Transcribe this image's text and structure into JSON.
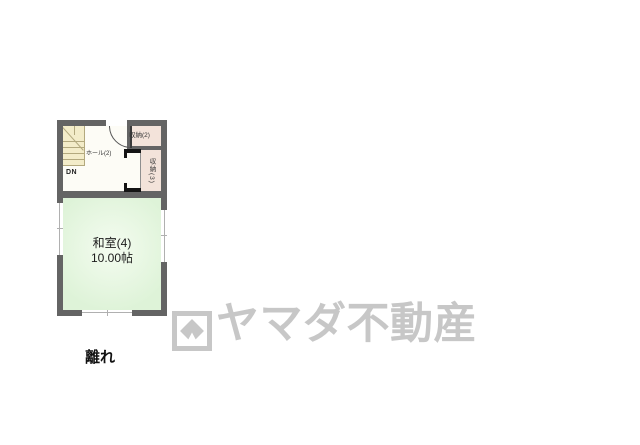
{
  "floorplan": {
    "caption": "離れ",
    "rooms": {
      "washitsu": {
        "name": "和室(4)",
        "area": "10.00帖"
      },
      "hall": {
        "name": "ホール(2)"
      },
      "storage_upper": {
        "name": "収納(2)"
      },
      "storage_side": {
        "name": "収納(3)"
      },
      "stairs": {
        "direction_label": "DN"
      }
    },
    "colors": {
      "wall": "#646464",
      "stairs_floor": "#f3ecc9",
      "hall_floor": "#fdfcf6",
      "storage_floor": "#f3e3da",
      "tatami_floor": "#e6f6e0"
    }
  },
  "watermark": {
    "brand": "ヤマダ不動産",
    "logo_icon": "yamada-diamond-logo",
    "color": "#c7c7c7"
  }
}
